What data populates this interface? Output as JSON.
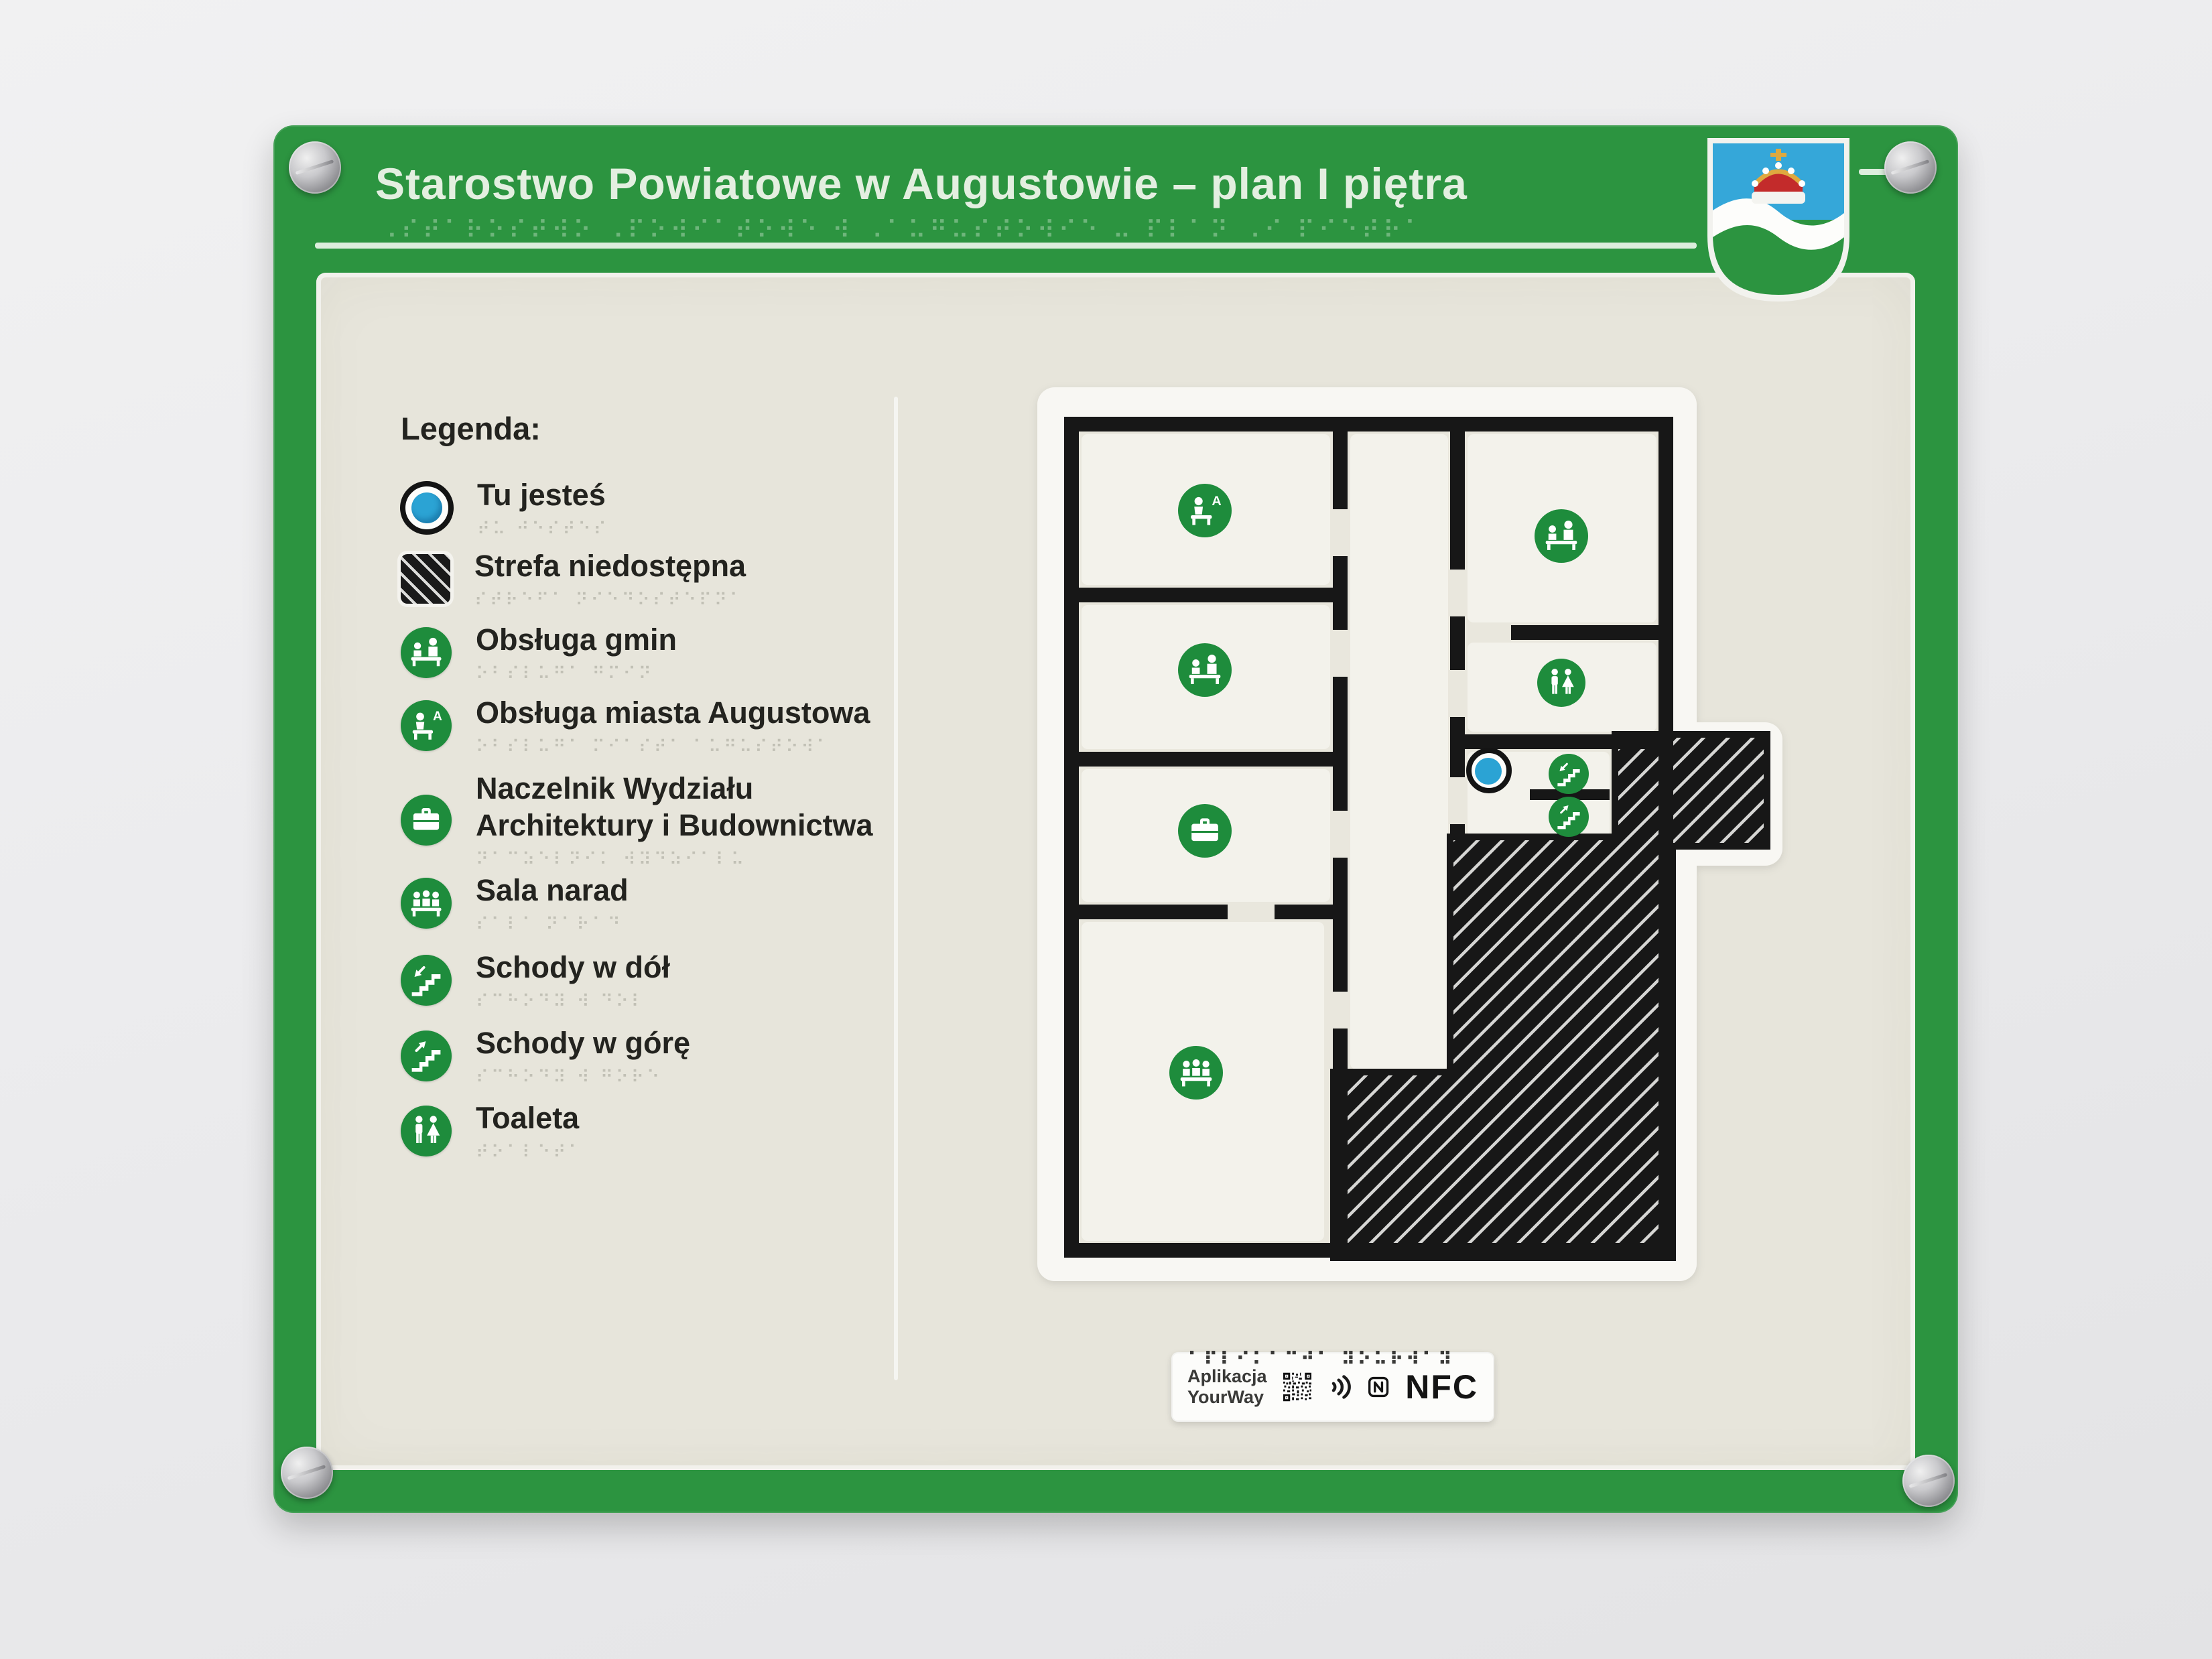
{
  "header": {
    "title": "Starostwo Powiatowe w Augustowie – plan I piętra",
    "braille": "⠠⠎⠞⠁⠗⠕⠎⠞⠺⠕ ⠠⠏⠕⠺⠊⠁⠞⠕⠺⠑ ⠺ ⠠⠁⠥⠛⠥⠎⠞⠕⠺⠊⠑ ⠤ ⠏⠇⠁⠝ ⠠⠊ ⠏⠊⠑⠞⠗⠁"
  },
  "coat_of_arms": {
    "name": "augustow-county-crest",
    "field_top_color": "#35a7d9",
    "wave_color": "#ffffff",
    "field_bottom_color": "#2c9440",
    "crown_colors": [
      "#c32b2b",
      "#dfa93f",
      "#ffffff"
    ]
  },
  "legend": {
    "heading": "Legenda:",
    "items": [
      {
        "icon": "you-are-here-icon",
        "label": "Tu jesteś",
        "braille": "⠞⠥ ⠚⠑⠎⠞⠑⠎"
      },
      {
        "icon": "inaccessible-zone-icon",
        "label": "Strefa niedostępna",
        "braille": "⠎⠞⠗⠑⠋⠁ ⠝⠊⠑⠙⠕⠎⠞⠑⠏⠝⠁"
      },
      {
        "icon": "municipal-service-icon",
        "label": "Obsługa gmin",
        "braille": "⠕⠃⠎⠇⠥⠛⠁ ⠛⠍⠊⠝"
      },
      {
        "icon": "city-service-icon",
        "label": "Obsługa miasta Augustowa",
        "braille": "⠕⠃⠎⠇⠥⠛⠁ ⠍⠊⠁⠎⠞⠁ ⠁⠥⠛⠥⠎⠞⠕⠺⠁"
      },
      {
        "icon": "department-head-icon",
        "label": "Naczelnik Wydziału Architektury i Budownictwa",
        "braille": "⠝⠁⠉⠵⠑⠇⠝⠊⠅ ⠺⠽⠙⠵⠊⠁⠇⠥"
      },
      {
        "icon": "meeting-room-icon",
        "label": "Sala narad",
        "braille": "⠎⠁⠇⠁ ⠝⠁⠗⠁⠙"
      },
      {
        "icon": "stairs-down-icon",
        "label": "Schody w dół",
        "braille": "⠎⠉⠓⠕⠙⠽ ⠺ ⠙⠕⠇"
      },
      {
        "icon": "stairs-up-icon",
        "label": "Schody w górę",
        "braille": "⠎⠉⠓⠕⠙⠽ ⠺ ⠛⠕⠗⠑"
      },
      {
        "icon": "toilet-icon",
        "label": "Toaleta",
        "braille": "⠞⠕⠁⠇⠑⠞⠁"
      }
    ]
  },
  "plan": {
    "rooms": [
      {
        "id": "room-city-service",
        "icon": "city-service-icon"
      },
      {
        "id": "room-municipal-service-left",
        "icon": "municipal-service-icon"
      },
      {
        "id": "room-department-head",
        "icon": "department-head-icon"
      },
      {
        "id": "room-meeting",
        "icon": "meeting-room-icon"
      },
      {
        "id": "room-municipal-service-right",
        "icon": "municipal-service-icon"
      },
      {
        "id": "room-toilet",
        "icon": "toilet-icon"
      },
      {
        "id": "room-stairs-down",
        "icon": "stairs-down-icon"
      },
      {
        "id": "room-stairs-up",
        "icon": "stairs-up-icon"
      }
    ],
    "you_are_here_marker": "Tu jesteś",
    "inaccessible_zone": "Strefa niedostępna"
  },
  "footer_tag": {
    "app_line1": "Aplikacja",
    "app_line2": "YourWay",
    "braille": "⠁⠏⠇⠊⠅⠁⠉⠚⠁ ⠽⠕⠥⠗⠺⠁⠽",
    "nfc_text": "NFC",
    "icons": [
      "qr-code-icon",
      "nfc-waves-icon",
      "nfc-mark-icon"
    ]
  },
  "colors": {
    "sign_green": "#2c9440",
    "icon_green": "#1e8c3c",
    "marker_blue": "#2ba3d4",
    "wall_black": "#171717",
    "panel_beige": "#e7e5db",
    "plate_white": "#f8f7f3"
  }
}
